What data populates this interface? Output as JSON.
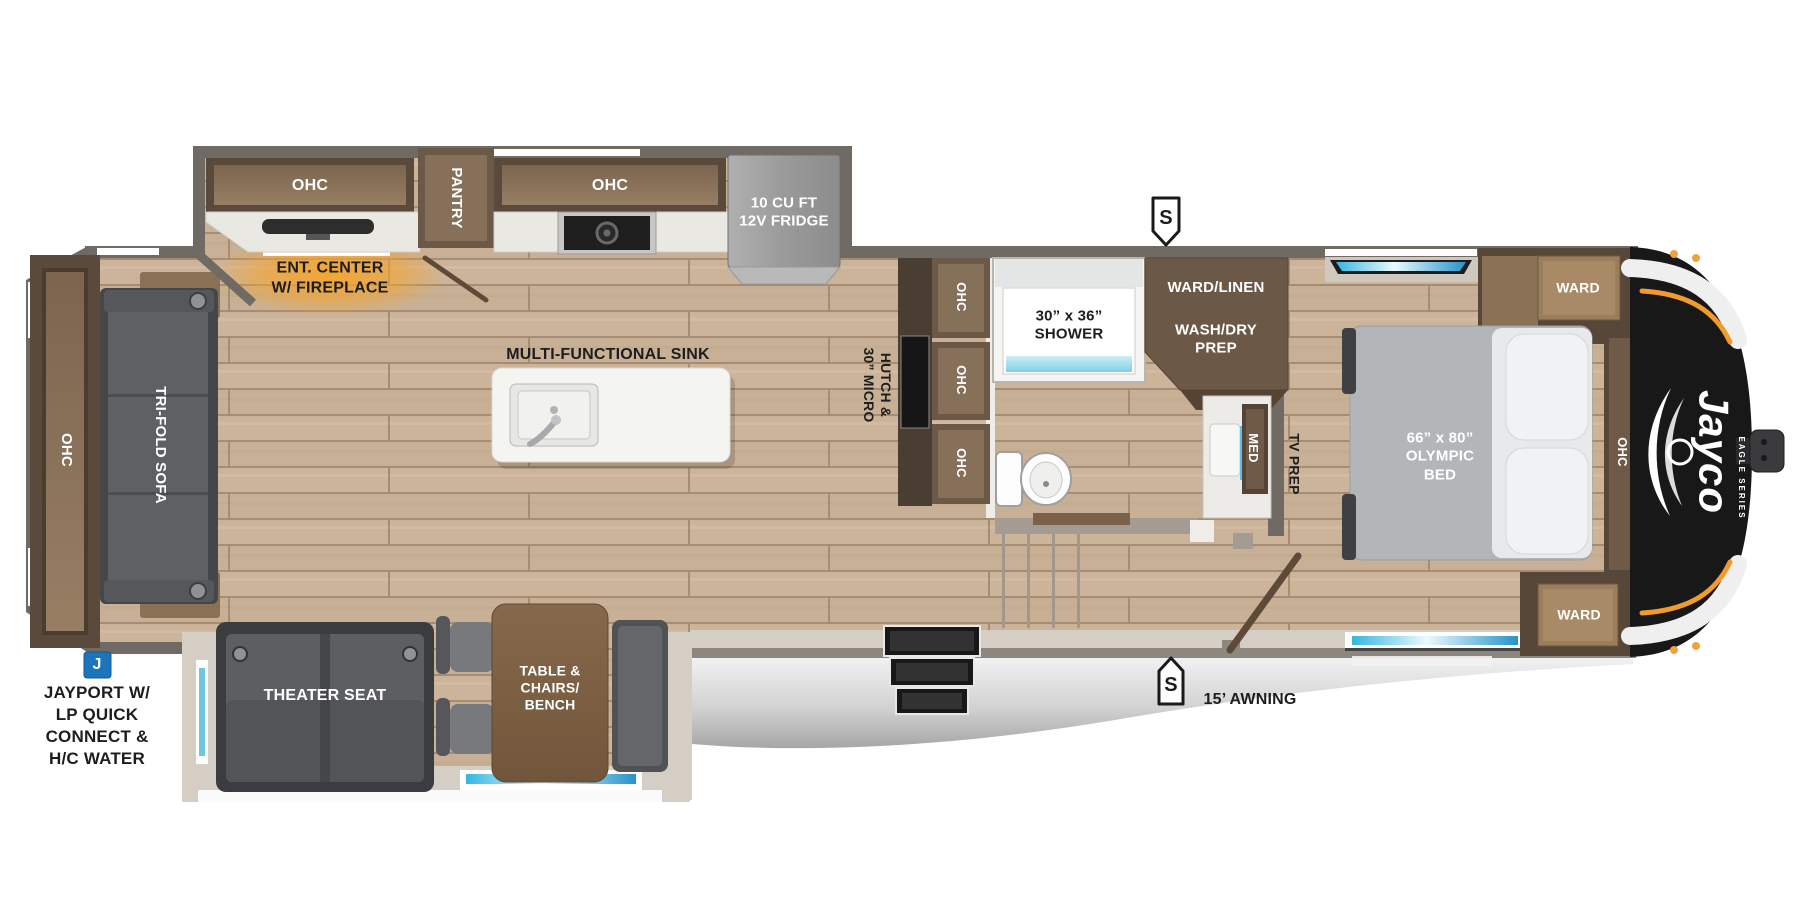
{
  "colors": {
    "wall": "#6f6a63",
    "inner_wall": "#d5cec4",
    "cabinet_dark": "#5a4a3b",
    "cabinet_mid": "#6b5847",
    "wood_front": "#87705a",
    "floor_wood": "#c8b096",
    "awning_gray": "#d2d2d2",
    "cap_black": "#181818",
    "accent_orange": "#f29b2d",
    "badge_blue": "#1c75bb",
    "window_blue": "#56c3e4"
  },
  "brand": {
    "logo": "Jayco",
    "series": "EAGLE SERIES"
  },
  "markers": {
    "s_top": "S",
    "s_bottom": "S",
    "jayport_badge": "J"
  },
  "exterior": {
    "awning_label": "15’ AWNING",
    "jayport_line1": "JAYPORT W/",
    "jayport_line2": "LP QUICK",
    "jayport_line3": "CONNECT &",
    "jayport_line4": "H/C WATER"
  },
  "kitchen": {
    "ohc_left": "OHC",
    "pantry": "PANTRY",
    "ohc_right": "OHC",
    "fridge_line1": "10 CU FT",
    "fridge_line2": "12V FRIDGE",
    "ent_line1": "ENT. CENTER",
    "ent_line2": "W/ FIREPLACE",
    "island_label": "MULTI-FUNCTIONAL SINK",
    "hutch_line1": "HUTCH &",
    "hutch_line2": "30” MICRO",
    "ohc_stack": [
      "OHC",
      "OHC",
      "OHC"
    ]
  },
  "bath": {
    "shower_line1": "30” x 36”",
    "shower_line2": "SHOWER",
    "ward_linen": "WARD/LINEN",
    "washdry_line1": "WASH/DRY",
    "washdry_line2": "PREP",
    "med": "MED",
    "tv_prep": "TV PREP"
  },
  "bedroom": {
    "ward_top": "WARD",
    "ward_bottom": "WARD",
    "ohc_side": "OHC",
    "bed_line1": "66” x 80”",
    "bed_line2": "OLYMPIC",
    "bed_line3": "BED"
  },
  "living": {
    "ohc_rear": "OHC",
    "sofa": "TRI-FOLD SOFA",
    "theater_seat": "THEATER SEAT",
    "dinette_line1": "TABLE &",
    "dinette_line2": "CHAIRS/",
    "dinette_line3": "BENCH"
  }
}
